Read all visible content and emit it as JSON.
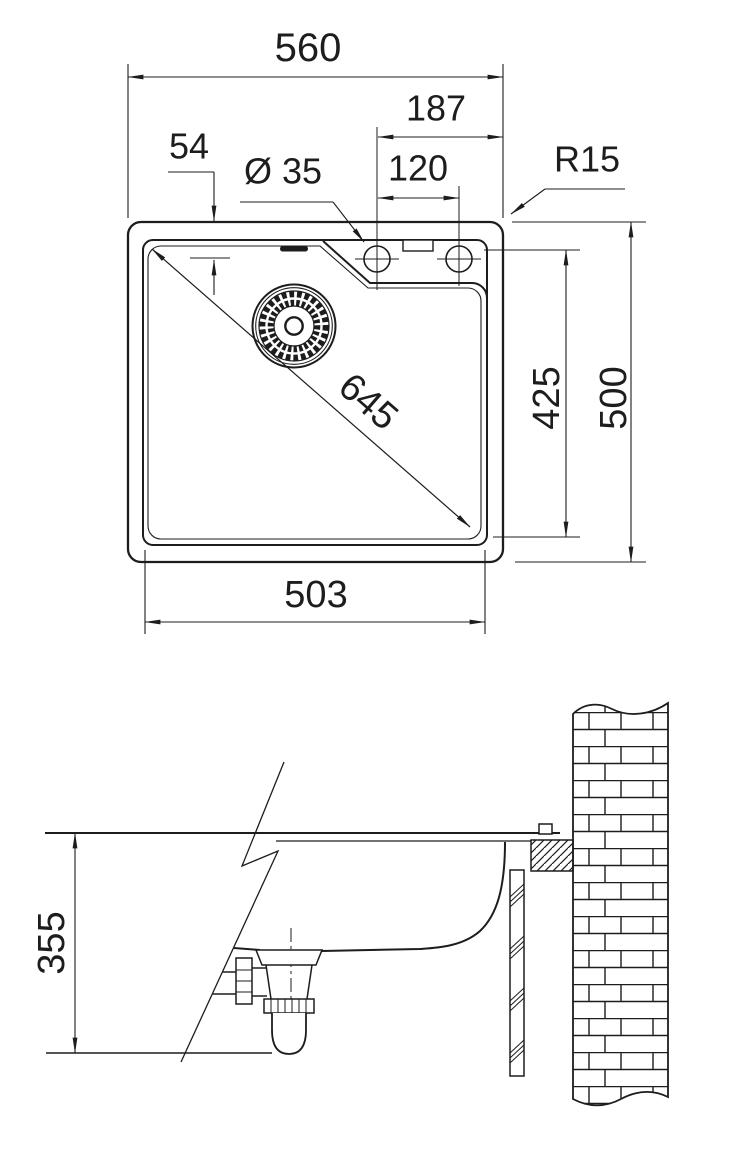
{
  "drawing": {
    "type": "sink-installation-technical-drawing",
    "labels": {
      "overall_width": "560",
      "ledge_width": "187",
      "hole_spacing": "120",
      "hole_edge_offset": "54",
      "hole_diameter": "Ø 35",
      "corner_radius": "R15",
      "diagonal": "645",
      "bowl_length": "425",
      "overall_depth": "500",
      "bowl_width": "503",
      "install_clearance": "355"
    },
    "colors": {
      "line": "#1d1d1d",
      "background": "#ffffff"
    }
  }
}
